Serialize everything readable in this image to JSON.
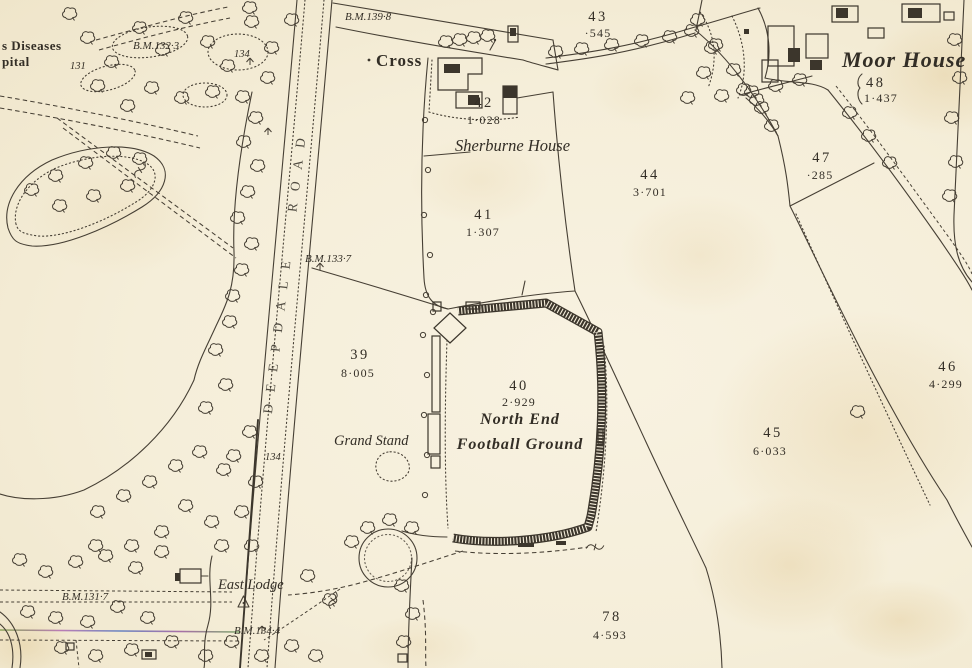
{
  "colors": {
    "paper": "#f5eedb",
    "ink": "#3f3a31"
  },
  "places": {
    "hospital_partial_line1": "s Diseases",
    "hospital_partial_line2": "pital",
    "cross": "Cross",
    "sherburne_house": "Sherburne House",
    "moor_house": "Moor House",
    "north_end_line1": "North End",
    "north_end_line2": "Football Ground",
    "grand_stand": "Grand Stand",
    "east_lodge": "East Lodge",
    "road_name": "DEEPDALE ROAD"
  },
  "benchmarks": {
    "bm_139_8": "B.M.139·8",
    "bm_132_3": "B.M.132·3",
    "bm_133_7": "B.M.133·7",
    "bm_131_7": "B.M.131·7",
    "bm_134_4": "B.M.134·4"
  },
  "spot_heights": {
    "h_131": "131",
    "h_134_park": "134",
    "h_134_road": "134"
  },
  "parcels": {
    "p39": {
      "number": "39",
      "area": "8·005"
    },
    "p40": {
      "number": "40",
      "area": "2·929"
    },
    "p41": {
      "number": "41",
      "area": "1·307"
    },
    "p42": {
      "number": "42",
      "area": "1·028"
    },
    "p43": {
      "number": "43",
      "area": "·545"
    },
    "p44": {
      "number": "44",
      "area": "3·701"
    },
    "p45": {
      "number": "45",
      "area": "6·033"
    },
    "p46": {
      "number": "46",
      "area": "4·299"
    },
    "p47": {
      "number": "47",
      "area": "·285"
    },
    "p48": {
      "number": "48",
      "area": "1·437"
    },
    "p78": {
      "number": "78",
      "area": "4·593"
    }
  },
  "map_features": {
    "trees": [
      [
        88,
        38
      ],
      [
        112,
        62
      ],
      [
        140,
        28
      ],
      [
        163,
        50
      ],
      [
        186,
        18
      ],
      [
        208,
        42
      ],
      [
        228,
        66
      ],
      [
        252,
        22
      ],
      [
        272,
        48
      ],
      [
        292,
        20
      ],
      [
        152,
        88
      ],
      [
        182,
        98
      ],
      [
        213,
        92
      ],
      [
        243,
        97
      ],
      [
        268,
        78
      ],
      [
        128,
        106
      ],
      [
        98,
        86
      ],
      [
        70,
        14
      ],
      [
        250,
        8
      ],
      [
        256,
        118
      ],
      [
        244,
        142
      ],
      [
        258,
        166
      ],
      [
        248,
        192
      ],
      [
        238,
        218
      ],
      [
        252,
        244
      ],
      [
        242,
        270
      ],
      [
        233,
        296
      ],
      [
        230,
        322
      ],
      [
        216,
        350
      ],
      [
        226,
        385
      ],
      [
        206,
        408
      ],
      [
        250,
        432
      ],
      [
        234,
        456
      ],
      [
        256,
        482
      ],
      [
        224,
        470
      ],
      [
        200,
        452
      ],
      [
        176,
        466
      ],
      [
        150,
        482
      ],
      [
        124,
        496
      ],
      [
        98,
        512
      ],
      [
        186,
        506
      ],
      [
        212,
        522
      ],
      [
        242,
        512
      ],
      [
        162,
        532
      ],
      [
        132,
        546
      ],
      [
        96,
        546
      ],
      [
        222,
        546
      ],
      [
        252,
        546
      ],
      [
        20,
        560
      ],
      [
        46,
        572
      ],
      [
        76,
        562
      ],
      [
        106,
        556
      ],
      [
        136,
        568
      ],
      [
        162,
        552
      ],
      [
        28,
        612
      ],
      [
        56,
        618
      ],
      [
        88,
        622
      ],
      [
        118,
        607
      ],
      [
        148,
        618
      ],
      [
        62,
        648
      ],
      [
        96,
        656
      ],
      [
        132,
        650
      ],
      [
        172,
        642
      ],
      [
        206,
        656
      ],
      [
        232,
        642
      ],
      [
        262,
        656
      ],
      [
        292,
        646
      ],
      [
        316,
        656
      ],
      [
        330,
        600
      ],
      [
        308,
        576
      ],
      [
        32,
        190
      ],
      [
        56,
        176
      ],
      [
        86,
        163
      ],
      [
        114,
        153
      ],
      [
        140,
        159
      ],
      [
        128,
        186
      ],
      [
        94,
        196
      ],
      [
        60,
        206
      ],
      [
        556,
        52
      ],
      [
        582,
        49
      ],
      [
        612,
        45
      ],
      [
        642,
        41
      ],
      [
        670,
        37
      ],
      [
        692,
        31
      ],
      [
        712,
        48
      ],
      [
        734,
        70
      ],
      [
        757,
        100
      ],
      [
        772,
        126
      ],
      [
        858,
        412
      ],
      [
        850,
        113
      ],
      [
        869,
        136
      ],
      [
        890,
        163
      ],
      [
        698,
        20
      ],
      [
        716,
        45
      ],
      [
        704,
        73
      ],
      [
        722,
        96
      ],
      [
        744,
        90
      ],
      [
        762,
        108
      ],
      [
        688,
        98
      ],
      [
        752,
        92
      ],
      [
        776,
        86
      ],
      [
        800,
        80
      ],
      [
        955,
        40
      ],
      [
        960,
        78
      ],
      [
        952,
        118
      ],
      [
        956,
        162
      ],
      [
        950,
        196
      ],
      [
        368,
        528
      ],
      [
        390,
        520
      ],
      [
        412,
        528
      ],
      [
        352,
        542
      ],
      [
        402,
        586
      ],
      [
        413,
        614
      ],
      [
        404,
        642
      ],
      [
        446,
        42
      ],
      [
        460,
        40
      ],
      [
        474,
        38
      ],
      [
        488,
        36
      ]
    ],
    "shrubs": [
      [
        425,
        120
      ],
      [
        428,
        170
      ],
      [
        424,
        215
      ],
      [
        430,
        255
      ],
      [
        426,
        295
      ],
      [
        423,
        335
      ],
      [
        427,
        375
      ],
      [
        424,
        415
      ],
      [
        427,
        455
      ],
      [
        425,
        495
      ],
      [
        433,
        312
      ]
    ]
  }
}
